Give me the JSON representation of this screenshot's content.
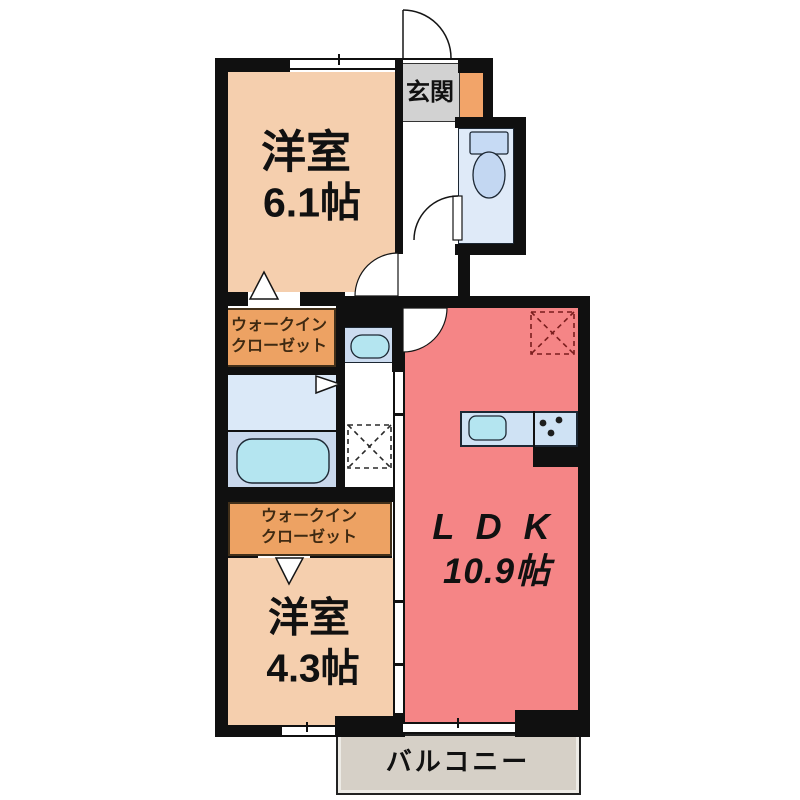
{
  "colors": {
    "wall": "#101010",
    "bedroom": "#f5cfae",
    "closet": "#eda263",
    "closet-border": "#42301a",
    "ldk": "#f58586",
    "water": "#dfeaf8",
    "washroom": "#dbe9f8",
    "bath": "#c9d8ec",
    "tub": "#b4e5f0",
    "counter": "#cfe2f4",
    "genkan": "#d2d2d2",
    "shoe": "#f2a469",
    "balcony": "#d6d0c7",
    "fixture-line": "#1c2733",
    "tank": "#c6daf4",
    "bowl": "#c3d7f2",
    "text": "#111111",
    "wic-text": "#3f2a12",
    "fridge-dash": "#7a1d1d"
  },
  "labels": {
    "entrance": "玄関",
    "bedroom1": {
      "name": "洋室",
      "size": "6.1帖"
    },
    "bedroom2": {
      "name": "洋室",
      "size": "4.3帖"
    },
    "ldk": {
      "name": "L D K",
      "size": "10.9帖"
    },
    "wic1": {
      "line1": "ウォークイン",
      "line2": "クローゼット"
    },
    "wic2": {
      "line1": "ウォークイン",
      "line2": "クローゼット"
    },
    "balcony": "バルコニー"
  },
  "fixtures": [
    "entrance-door",
    "toilet",
    "toilet-door",
    "bedroom1-door",
    "ldk-door",
    "washbasin",
    "washing-machine-space",
    "bathtub",
    "folding-door-marker",
    "closet-door-marker-1",
    "closet-door-marker-2",
    "kitchen-sink",
    "gas-stove",
    "refrigerator-space",
    "window-bedroom1",
    "window-bedroom2",
    "window-balcony"
  ]
}
